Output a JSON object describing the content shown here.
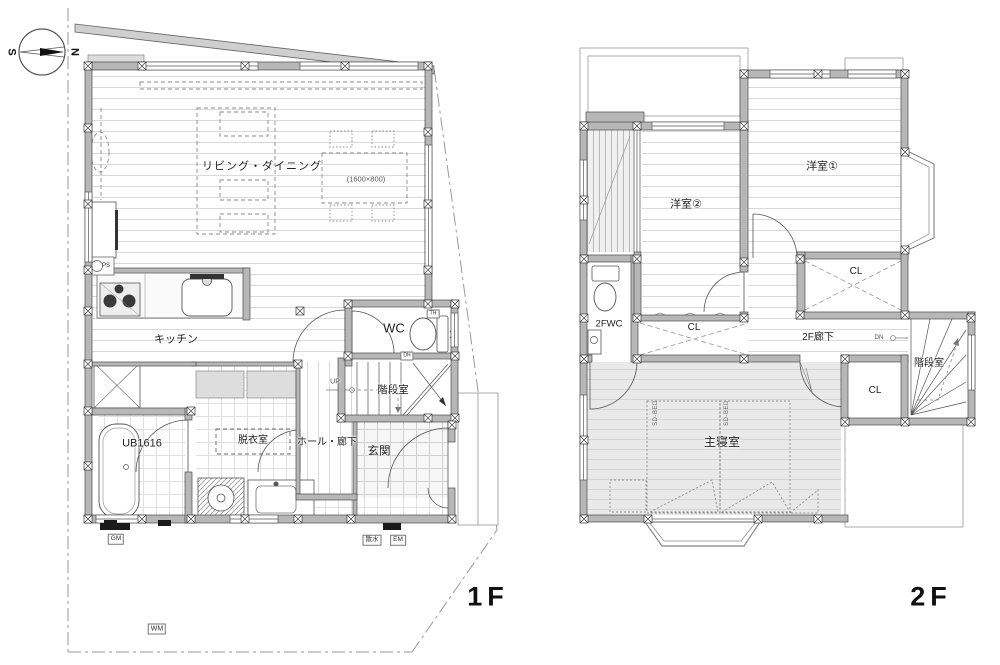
{
  "compass": {
    "north": "N",
    "south": "S"
  },
  "floor1": {
    "floor_label": "1F",
    "living_dining": "リビング・ダイニング",
    "table_size": "(1600×800)",
    "kitchen": "キッチン",
    "ps": "PS",
    "wc": "WC",
    "th": "TH",
    "dh": "DH",
    "stairs": "階段室",
    "up": "UP",
    "entrance": "玄関",
    "hall": "ホール・廊下",
    "dressing": "脱衣室",
    "bath": "UB1616",
    "gm": "GM",
    "sprinkler": "散水",
    "em": "EM",
    "wm": "WM"
  },
  "floor2": {
    "floor_label": "2F",
    "room1": "洋室①",
    "room2": "洋室②",
    "cl_top": "CL",
    "cl_right": "CL",
    "cl_stairs": "CL",
    "wc": "2FWC",
    "hall": "2F廊下",
    "dn": "DN",
    "stairs": "階段室",
    "master": "主寝室",
    "bed1": "SD-BED",
    "bed2": "SD-BED"
  }
}
